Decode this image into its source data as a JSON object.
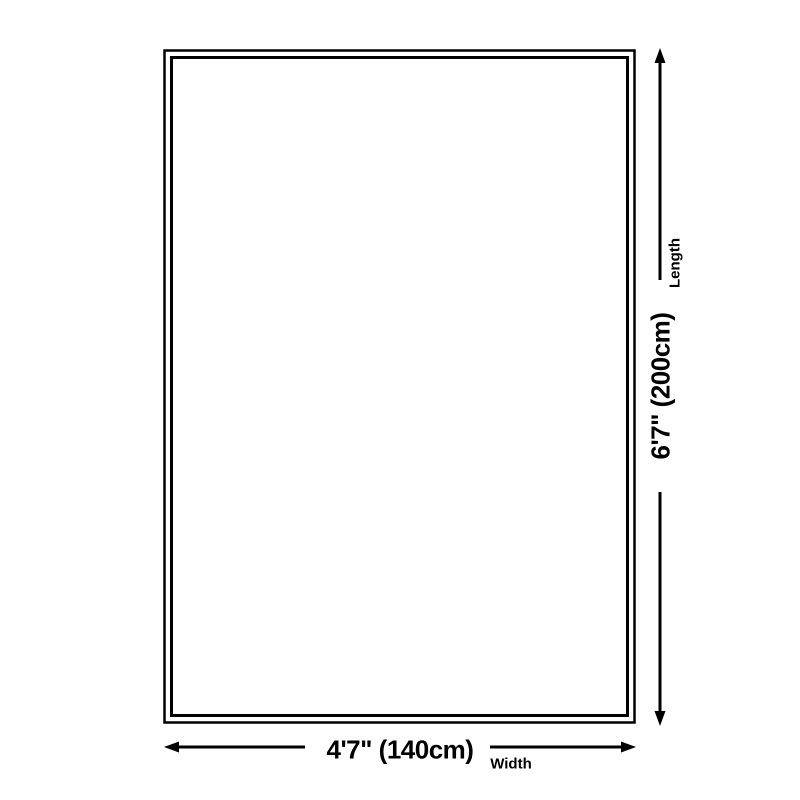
{
  "diagram": {
    "kind": "product-dimension-diagram",
    "shape": "rectangle",
    "background_color": "#ffffff",
    "line_color": "#000000",
    "length_dimension": {
      "value": "6'7\" (200cm)",
      "axis_label": "Length",
      "orientation": "vertical"
    },
    "width_dimension": {
      "value": "4'7\" (140cm)",
      "axis_label": "Width",
      "orientation": "horizontal"
    }
  }
}
